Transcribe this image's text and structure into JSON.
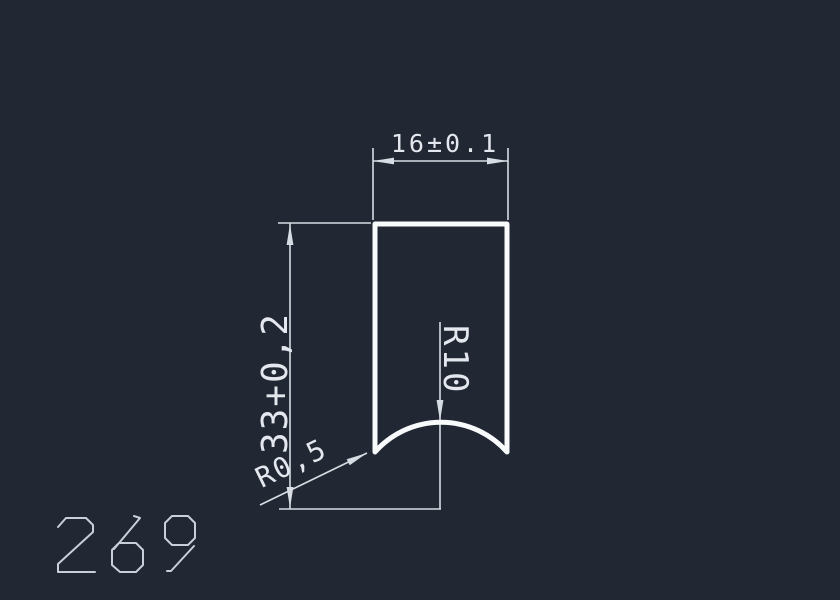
{
  "colors": {
    "background": "#212833",
    "outline": "#f8fafc",
    "dimension": "#d8dde4",
    "label_text": "#e4e8ee",
    "part_number": "#c9cfd8"
  },
  "drawing": {
    "part_number": "269",
    "dimensions": {
      "width": "16±0.1",
      "height": "33+0,2",
      "radius": "R10",
      "fillet": "R0,5"
    }
  }
}
